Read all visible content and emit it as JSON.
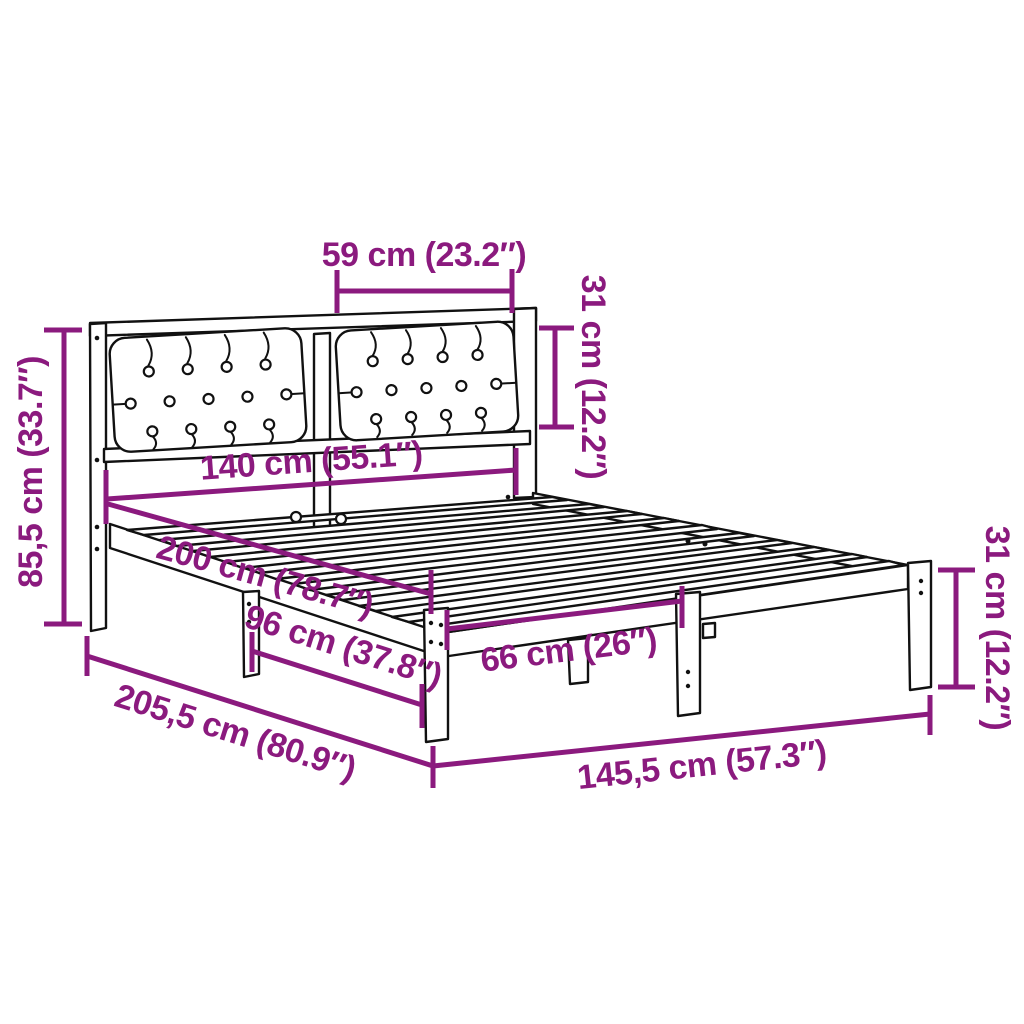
{
  "diagram": {
    "background_color": "#FFFFFF",
    "accent_color": "#8B1A7E",
    "outline_color": "#111111"
  },
  "dimensions": {
    "cushion_width": "59 cm (23.2″)",
    "headboard_panel_height": "31 cm (12.2″)",
    "headboard_height": "85,5 cm (33.7″)",
    "mattress_width": "140 cm (55.1″)",
    "mattress_length": "200 cm (78.7″)",
    "leg_spacing": "96 cm (37.8″)",
    "leg_gap": "66 cm (26″)",
    "total_length": "205,5 cm (80.9″)",
    "total_width": "145,5 cm (57.3″)",
    "leg_height": "31 cm (12.2″)"
  }
}
